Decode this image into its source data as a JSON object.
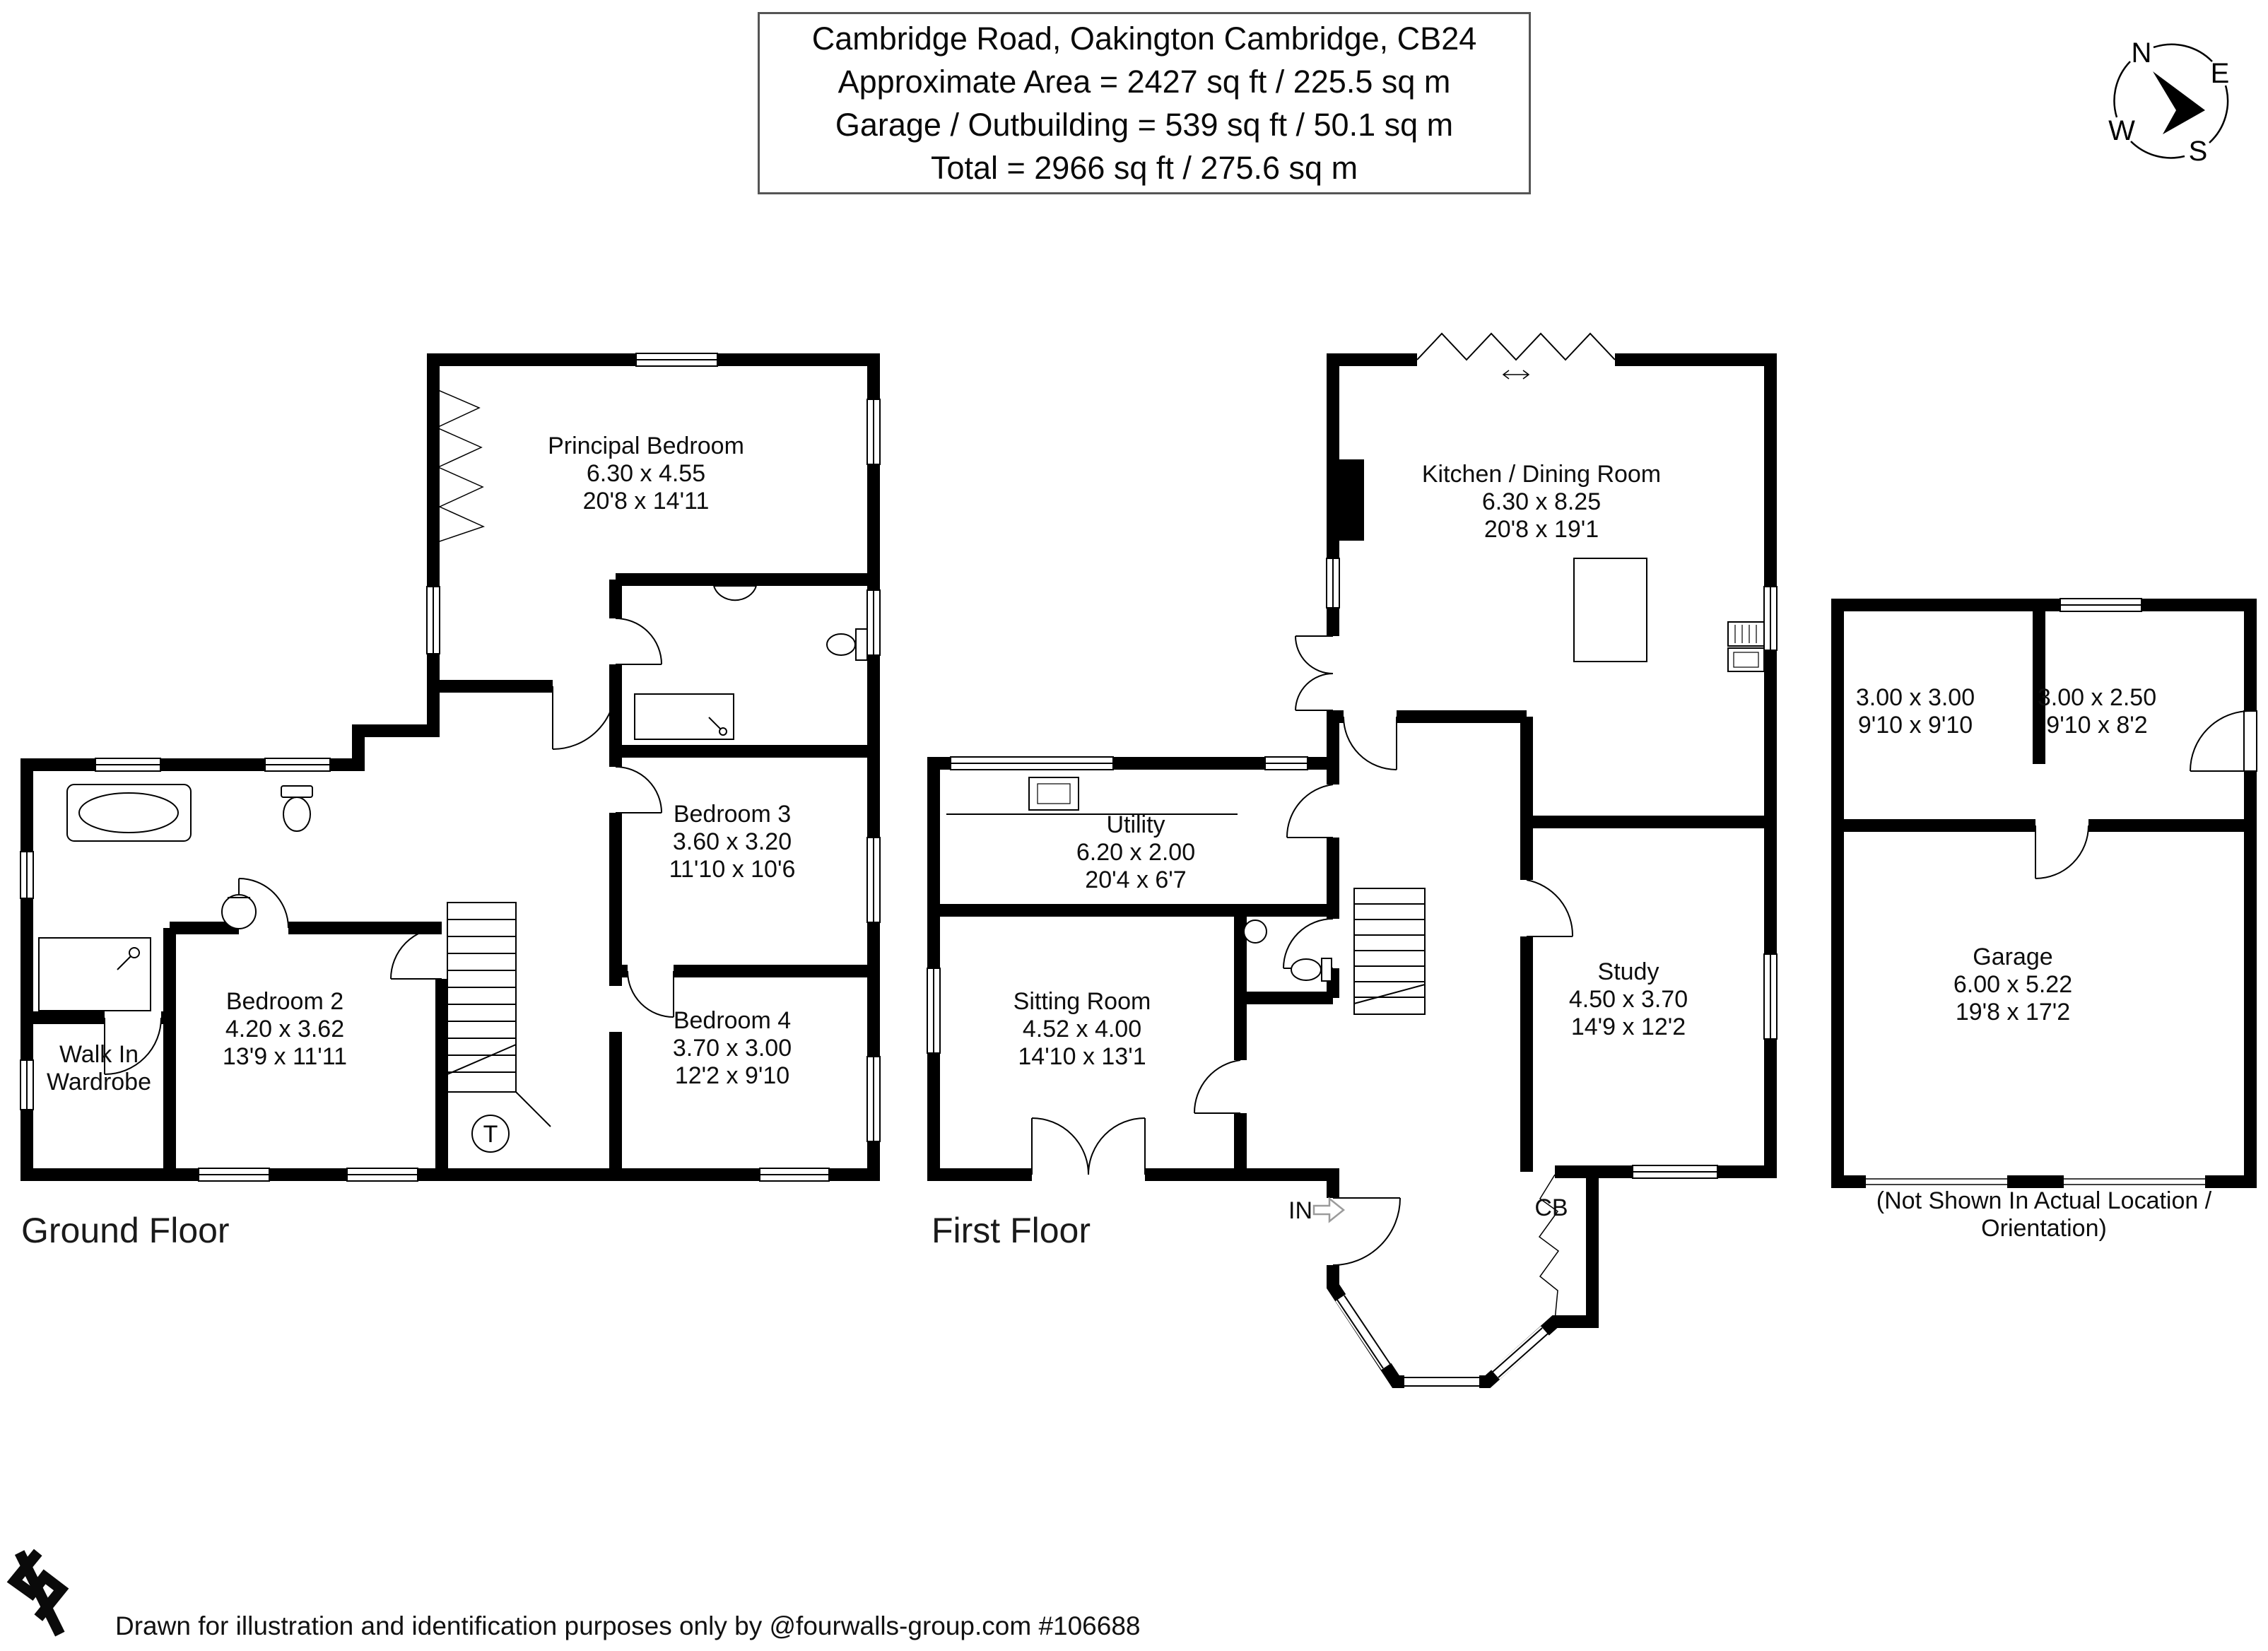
{
  "title": {
    "line1": "Cambridge Road, Oakington Cambridge, CB24",
    "line2": "Approximate Area = 2427 sq ft / 225.5 sq m",
    "line3": "Garage / Outbuilding = 539 sq ft / 50.1 sq m",
    "line4": "Total = 2966 sq ft / 275.6 sq m"
  },
  "compass": {
    "n": "N",
    "e": "E",
    "s": "S",
    "w": "W"
  },
  "floors": {
    "ground": "Ground Floor",
    "first": "First Floor"
  },
  "rooms": {
    "principal": {
      "name": "Principal Bedroom",
      "metric": "6.30 x 4.55",
      "imperial": "20'8 x 14'11"
    },
    "bedroom3": {
      "name": "Bedroom 3",
      "metric": "3.60 x 3.20",
      "imperial": "11'10 x 10'6"
    },
    "bedroom2": {
      "name": "Bedroom 2",
      "metric": "4.20 x 3.62",
      "imperial": "13'9 x 11'11"
    },
    "bedroom4": {
      "name": "Bedroom 4",
      "metric": "3.70 x 3.00",
      "imperial": "12'2 x 9'10"
    },
    "wardrobe": {
      "name": "Walk In Wardrobe"
    },
    "kitchen": {
      "name": "Kitchen / Dining Room",
      "metric": "6.30 x 8.25",
      "imperial": "20'8 x 19'1"
    },
    "utility": {
      "name": "Utility",
      "metric": "6.20 x 2.00",
      "imperial": "20'4 x 6'7"
    },
    "sitting": {
      "name": "Sitting Room",
      "metric": "4.52 x 4.00",
      "imperial": "14'10 x 13'1"
    },
    "study": {
      "name": "Study",
      "metric": "4.50 x 3.70",
      "imperial": "14'9 x 12'2"
    },
    "store1": {
      "metric": "3.00 x 3.00",
      "imperial": "9'10 x 9'10"
    },
    "store2": {
      "metric": "3.00 x 2.50",
      "imperial": "9'10 x 8'2"
    },
    "garage": {
      "name": "Garage",
      "metric": "6.00 x 5.22",
      "imperial": "19'8 x 17'2"
    }
  },
  "markers": {
    "entrance": "IN",
    "cupboard": "CB",
    "thermostat": "T"
  },
  "outbuilding_note": "(Not Shown In Actual Location / Orientation)",
  "footer": "Drawn for illustration and identification purposes only by @fourwalls-group.com #106688",
  "colors": {
    "wall": "#000000",
    "entry_arrow": "#9b9b9b",
    "title_border": "#555555"
  }
}
